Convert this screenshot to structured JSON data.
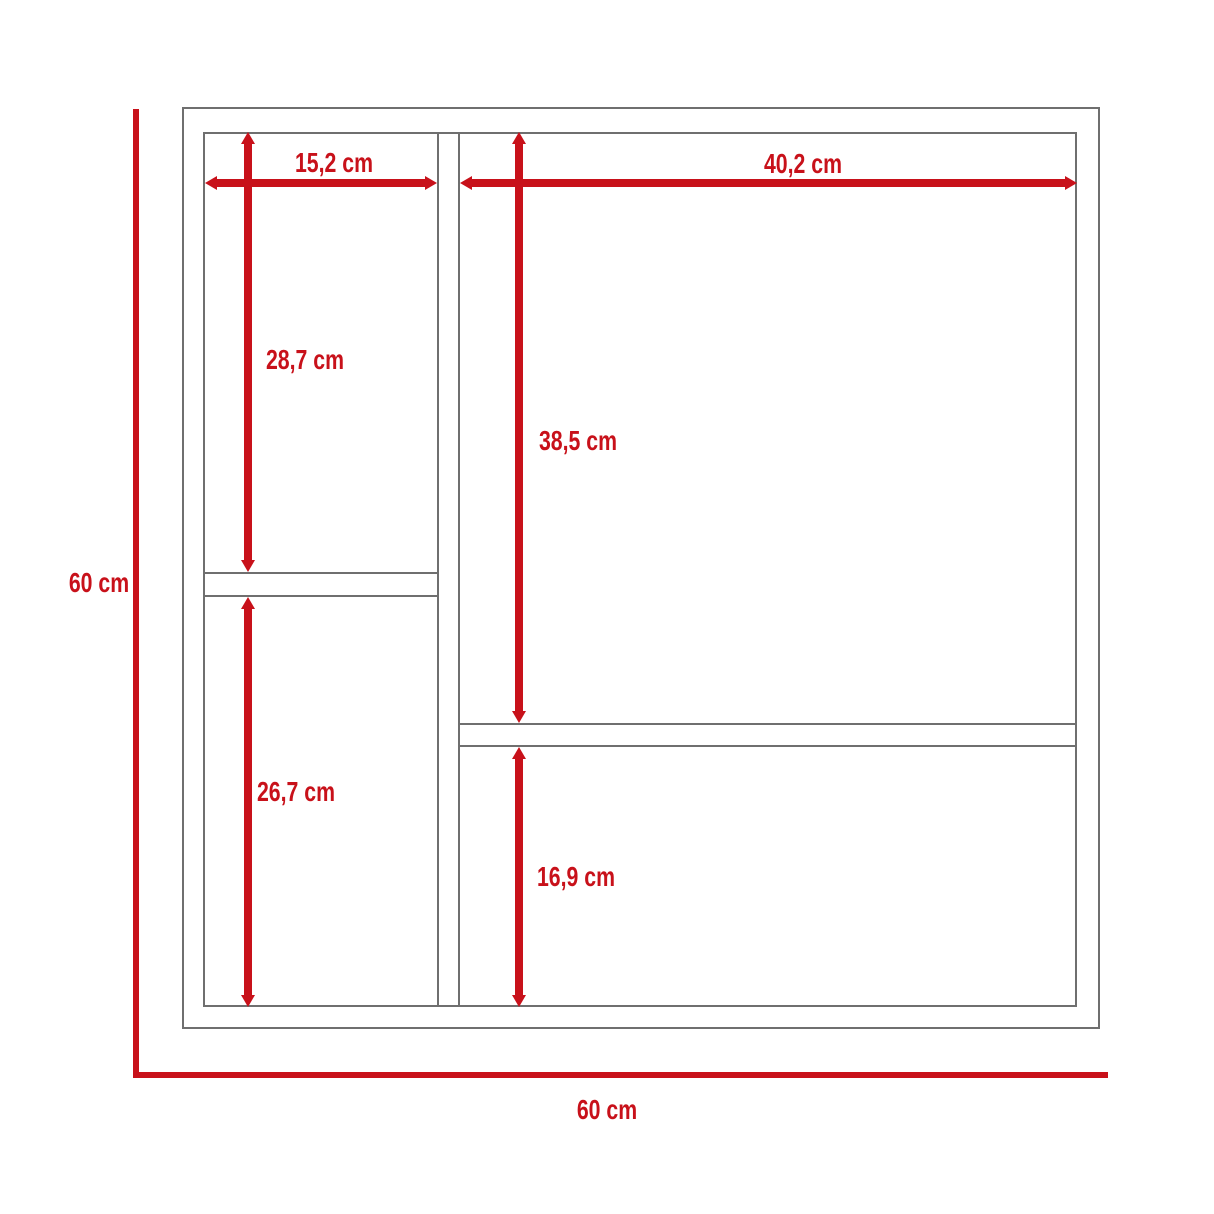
{
  "diagram": {
    "title": "cabinet-dimension-diagram",
    "unit": "cm",
    "colors": {
      "dimension_red": "#C8111A",
      "frame_gray": "#6F6F6F",
      "background": "#FFFFFF"
    },
    "labels": {
      "left_column_width": "15,2 cm",
      "right_column_width": "40,2 cm",
      "left_upper_section_height": "28,7 cm",
      "right_upper_section_height": "38,5 cm",
      "left_lower_section_height": "26,7 cm",
      "right_lower_section_height": "16,9 cm",
      "overall_height": "60 cm",
      "overall_width": "60 cm"
    }
  }
}
